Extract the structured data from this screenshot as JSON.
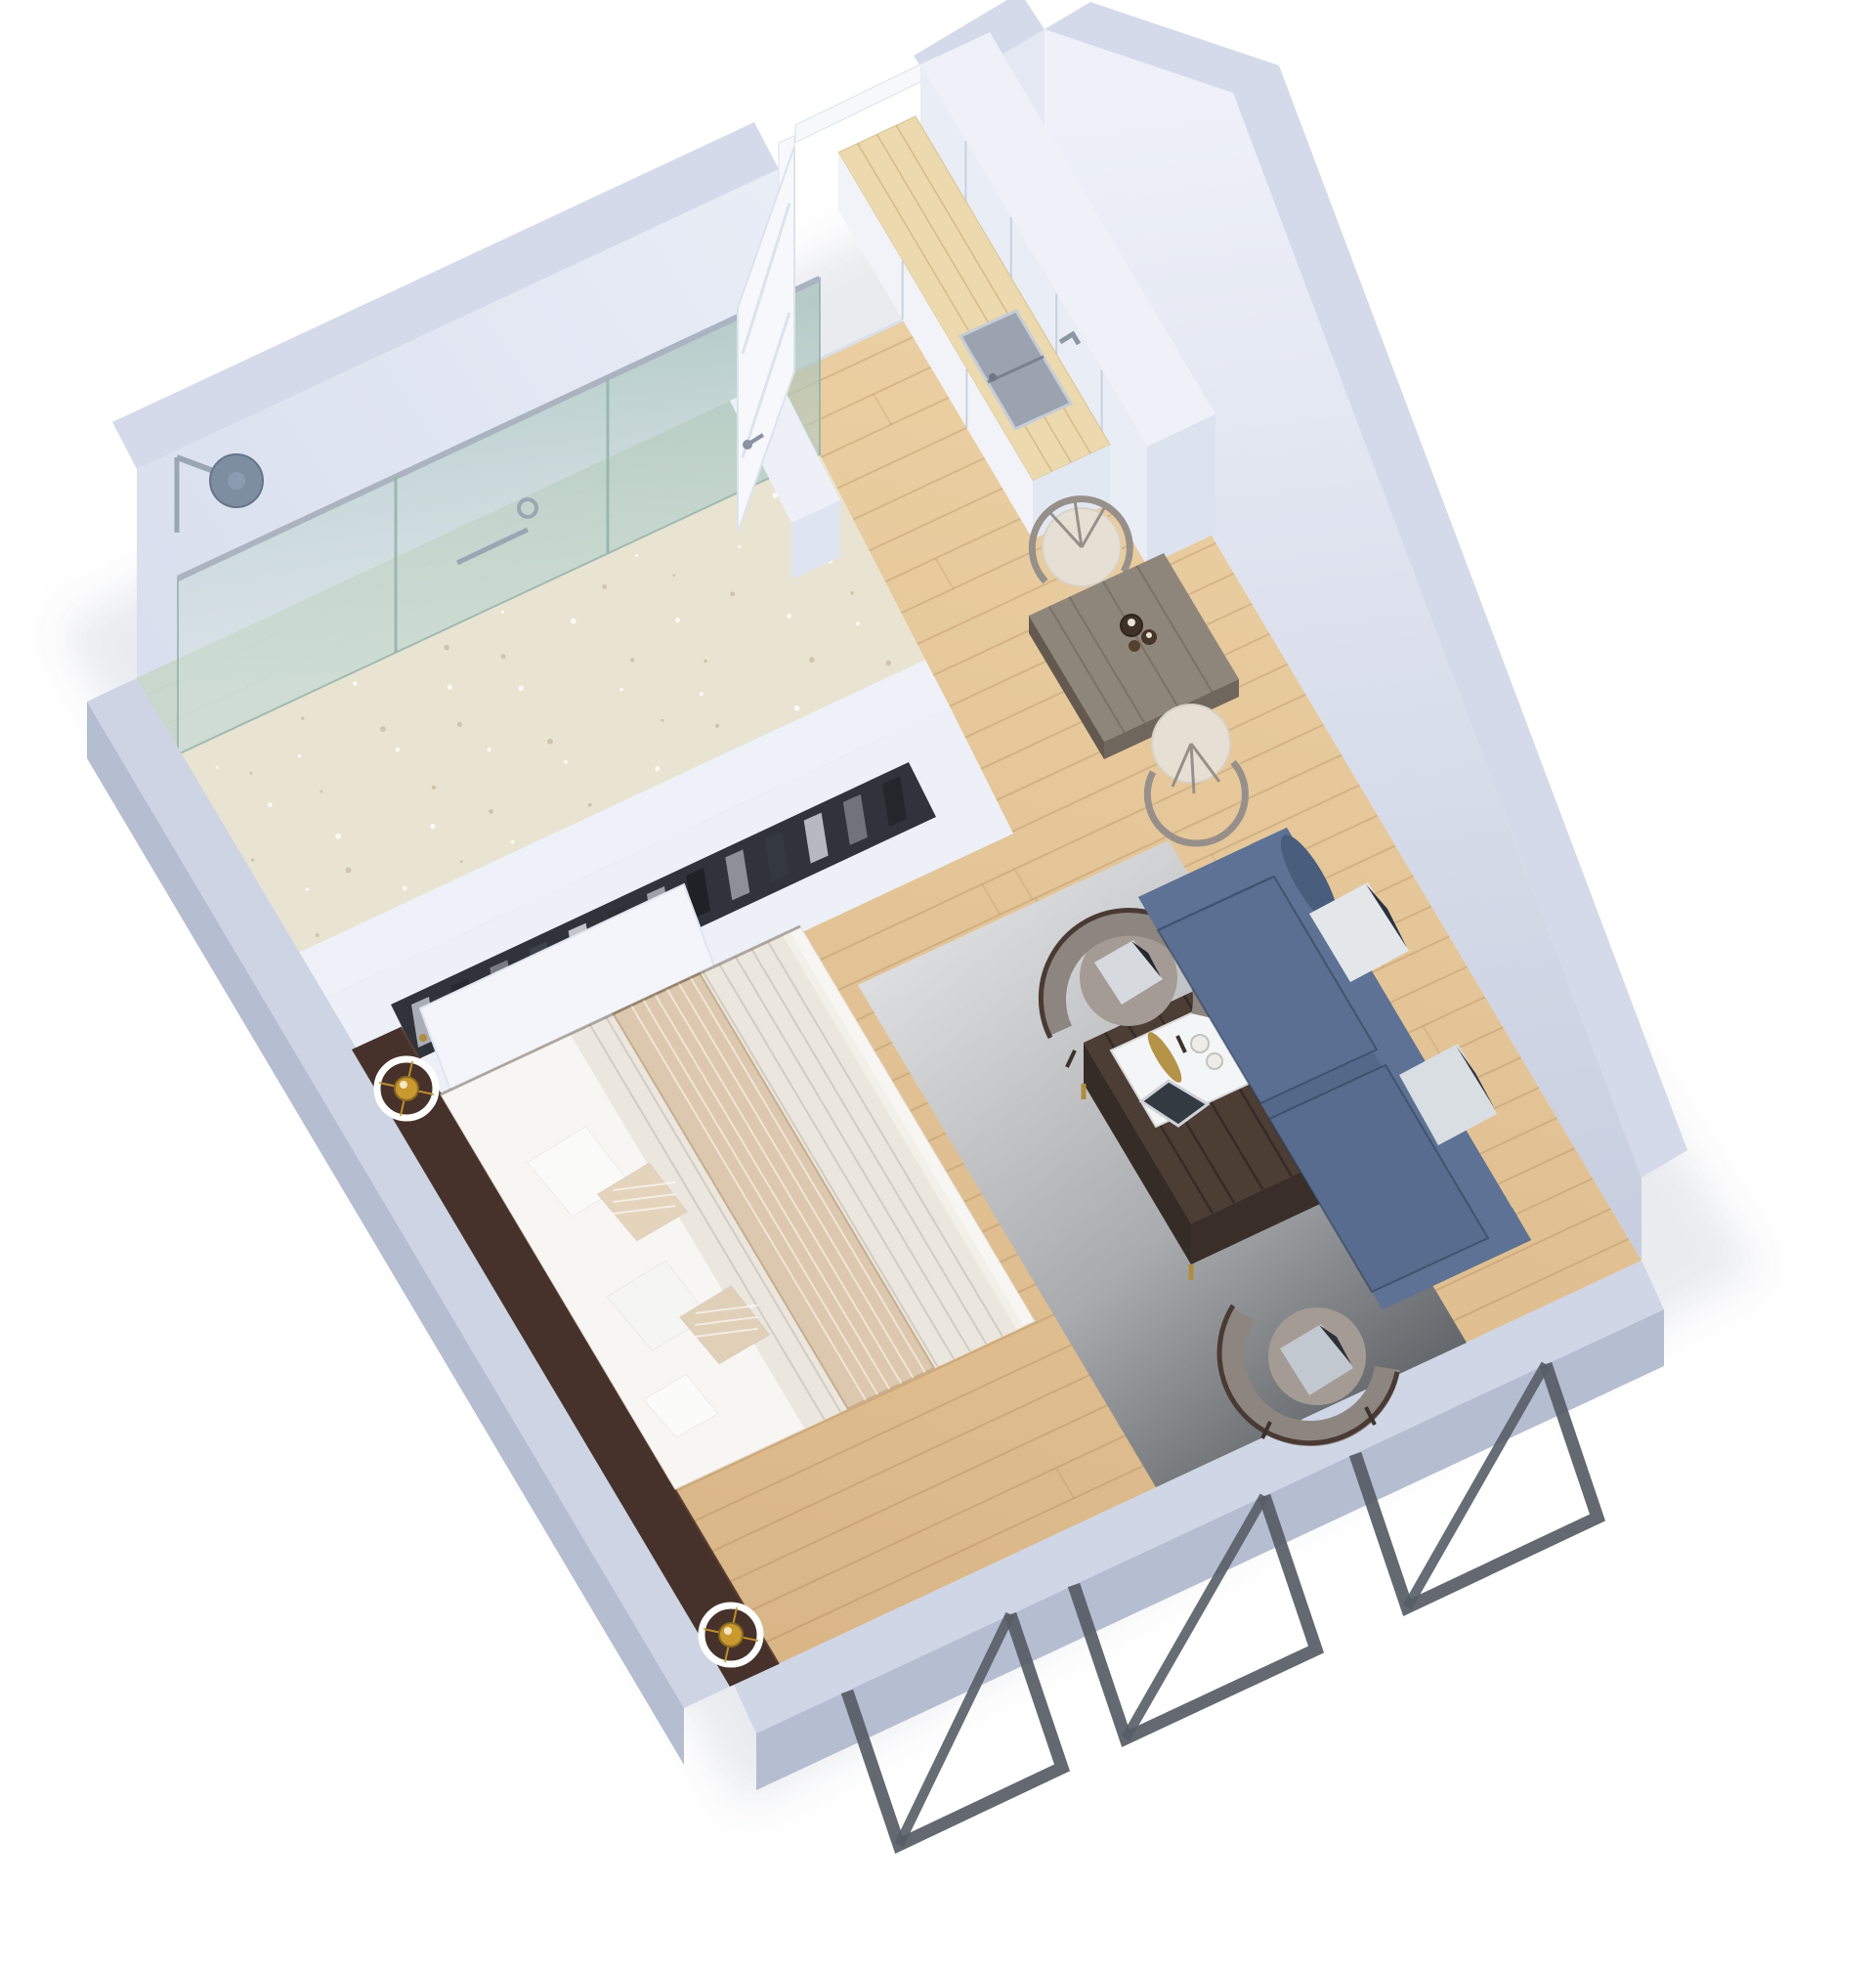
{
  "scene": {
    "title": "3D isometric floor plan of a studio apartment",
    "background": "#ffffff"
  },
  "palette": {
    "wall_top": "#d4dae9",
    "wall_face": "#e4e8f3",
    "wall_face_dark": "#c9d0e0",
    "wall_outer": "#b5bdd1",
    "floor_wood": "#e4c79b",
    "floor_wood_dark": "#d6b282",
    "plank_line": "rgba(140,95,50,0.20)",
    "bath_floor": "#e9e4d2",
    "bath_speckle": "#c9c0a4",
    "shower_zone": "#c5d8d2",
    "glass_edge": "rgba(140,175,165,0.75)",
    "chrome": "#9aa6b4",
    "shower_head": "#7e8ea1",
    "door_white": "#f6f8fc",
    "door_line": "#dde2ec",
    "cabinet_white": "#eef1f8",
    "cabinet_face": "#e9edf5",
    "cabinet_side": "#dde3ee",
    "counter_wood": "#ecd9ae",
    "counter_front": "#f1f3f8",
    "sink_steel": "#9aa3af",
    "sink_rim": "#c6cdd6",
    "table_wood": "#8f867b",
    "table_side": "#6f665d",
    "chair_frame": "#97908a",
    "chair_cushion": "#e6e0d4",
    "sofa_blue": "#54688a",
    "sofa_blue_dark": "#475a7a",
    "sofa_blue_light": "#5d7294",
    "rug_light": "#dcdfe2",
    "rug_dark": "#54595f",
    "pillow_white": "#e3e7ea",
    "pillow_fold": "#2a3140",
    "leather": "#a39b94",
    "leather_band": "#8d857f",
    "chair_trim": "#4a3a34",
    "ctable_top": "#4c3d35",
    "ctable_side": "#362c26",
    "gold": "#b08d3e",
    "amber": "#a3571e",
    "tray_white": "#f4f5f6",
    "bed_white": "#fafaf8",
    "mattress": "#f7f6f2",
    "duvet": "#ebe7df",
    "blanket": "#dcc8ae",
    "pillow_beige": "#e4d4bc",
    "headboard": "#46322a",
    "lamp_brass": "#c9982f",
    "metal_frame": "#575d66",
    "clothes_slot": "#30343a"
  },
  "rooms": {
    "bathroom": {
      "label": "Bathroom",
      "items": [
        {
          "name": "walk-in-shower",
          "label": "Walk-in shower with glass partition"
        },
        {
          "name": "shower-head",
          "label": "Wall-mounted rain shower head"
        },
        {
          "name": "terrazzo-floor",
          "label": "Speckled terrazzo floor"
        }
      ]
    },
    "entry": {
      "label": "Entry",
      "items": [
        {
          "name": "entry-door",
          "label": "White panelled entry door (open)"
        }
      ]
    },
    "kitchen": {
      "label": "Kitchenette",
      "items": [
        {
          "name": "tall-cabinets",
          "label": "White cabinet wall"
        },
        {
          "name": "counter",
          "label": "Light wood countertop"
        },
        {
          "name": "sink",
          "label": "Stainless steel sink with faucet"
        }
      ]
    },
    "dining": {
      "label": "Dining area",
      "items": [
        {
          "name": "dining-table",
          "label": "Square grey-wood table"
        },
        {
          "name": "dining-chairs",
          "label": "Two curved-back chairs",
          "count": 2
        },
        {
          "name": "candle-set",
          "label": "Candle holders"
        }
      ]
    },
    "living": {
      "label": "Living area",
      "items": [
        {
          "name": "sofa",
          "label": "Blue fabric sofa with two white pillows"
        },
        {
          "name": "armchairs",
          "label": "Two grey leather barrel armchairs",
          "count": 2
        },
        {
          "name": "coffee-table",
          "label": "Dark wood coffee table with tray and amber dish"
        },
        {
          "name": "rug",
          "label": "Grey ombre rug"
        }
      ]
    },
    "bedroom": {
      "label": "Sleeping area",
      "items": [
        {
          "name": "double-bed",
          "label": "Double bed with knit duvet and striped blanket"
        },
        {
          "name": "headboard-console",
          "label": "Dark walnut headboard console"
        },
        {
          "name": "ring-lamps",
          "label": "Two brass ring lamps",
          "count": 2
        },
        {
          "name": "wardrobe",
          "label": "Built-in wardrobe with hanging clothes"
        }
      ]
    }
  },
  "exterior": {
    "items": [
      {
        "name": "window-frames",
        "label": "Metal window frames on lower wall",
        "count": 3
      }
    ]
  }
}
